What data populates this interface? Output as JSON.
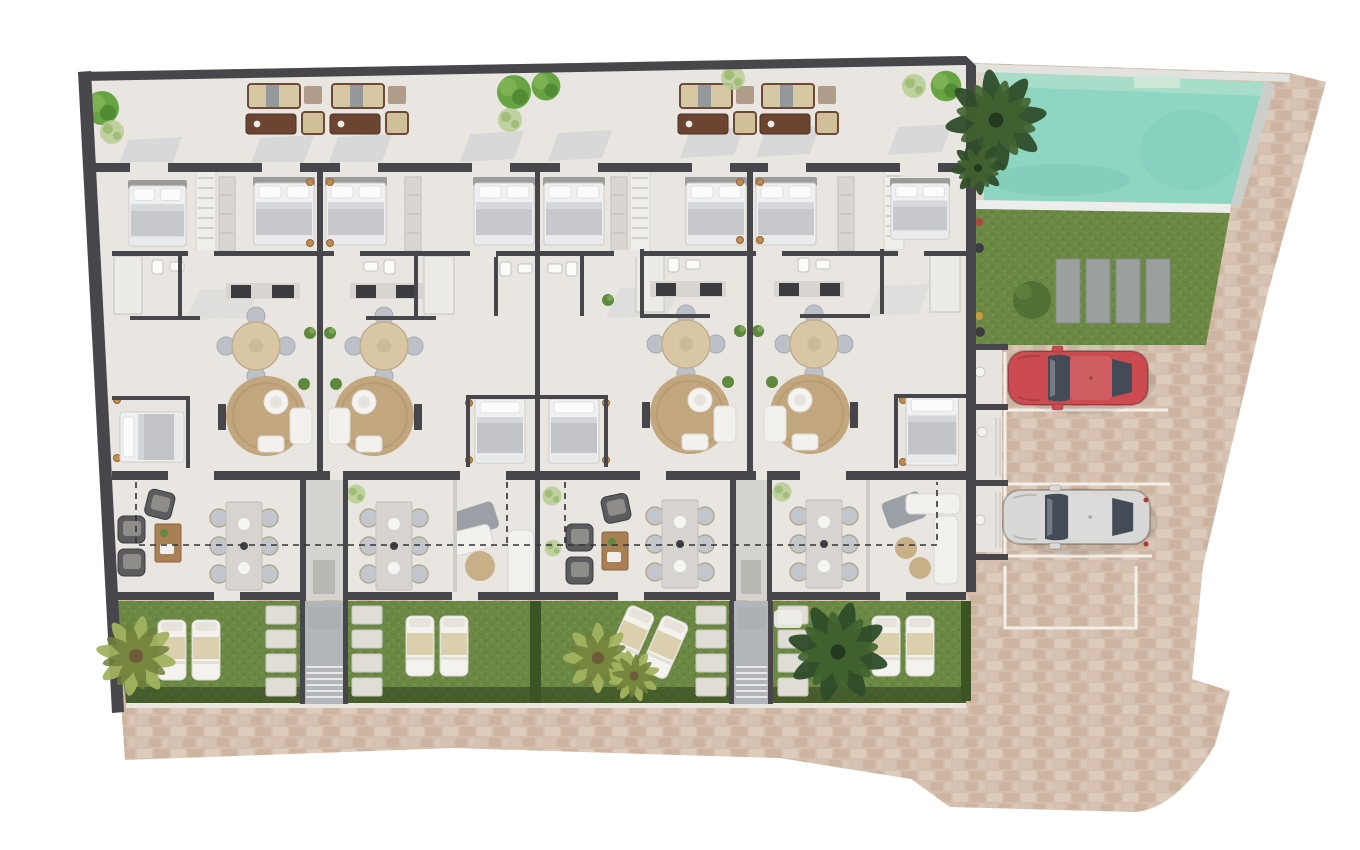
{
  "meta": {
    "kind": "architectural-site-plan-render",
    "view": "top-down",
    "background": "#ffffff"
  },
  "colors": {
    "wall": "#47464a",
    "wall_light": "#cfccc8",
    "floor": "#e9e6e1",
    "floor_light": "#efedea",
    "terrace_shadow": "#c2c7cf",
    "cobble": "#d8c3b2",
    "cobble_stone_light": "#e3d4c6",
    "cobble_stone_dark": "#c9ab96",
    "lawn": "#6b8845",
    "lawn_dark": "#2f4520",
    "hedge": "#3c5324",
    "pool_water": "#8ed5c2",
    "pool_water_light": "#abdecb",
    "pool_step": "#cfe7d6",
    "pool_curb": "#e4e4e0",
    "rug": "#c2a67e",
    "wood": "#a97f54",
    "sofa_brown": "#6b4530",
    "cushion_beige": "#d3c49c",
    "furniture_white": "#f2f1ee",
    "furniture_gray": "#b9bdc5",
    "bed_duvet": "#c7c9cd",
    "closet": "#d9d6d2",
    "counter_dark": "#3c3c40",
    "walkway": "#b2b5ba",
    "stepping_stone": "#e0ddd6",
    "pad_gray": "#9aa09e",
    "car_red": "#cb4b50",
    "car_white": "#d8d8d6",
    "car_glass": "#434b56",
    "lamp_gold": "#c08b4f",
    "dashed_line": "#333333",
    "parking_line": "#f2efe9",
    "palm_dark": "#2f4d2a",
    "palm_mid": "#41632f",
    "palm_light": "#a3b35f",
    "tree_green": "#68a344",
    "bush_light": "#b6cc92",
    "trunk": "#8a6b4a"
  },
  "inventory": {
    "swimming_pools": 1,
    "cars": [
      {
        "name": "red-car",
        "color": "#cb4b50"
      },
      {
        "name": "white-car",
        "color": "#d8d8d6"
      }
    ],
    "parking_stalls": 4,
    "garden_lawns": 5,
    "garden_walkways": 2,
    "lawn_pads": 4,
    "palm_trees": 4,
    "sun_loungers": 9,
    "outdoor_sofa_sets": 4,
    "round_dining_tables": 4,
    "rect_dining_tables": 4,
    "living_rugs": 4,
    "beds": 12,
    "stepping_stone_columns": 4
  }
}
